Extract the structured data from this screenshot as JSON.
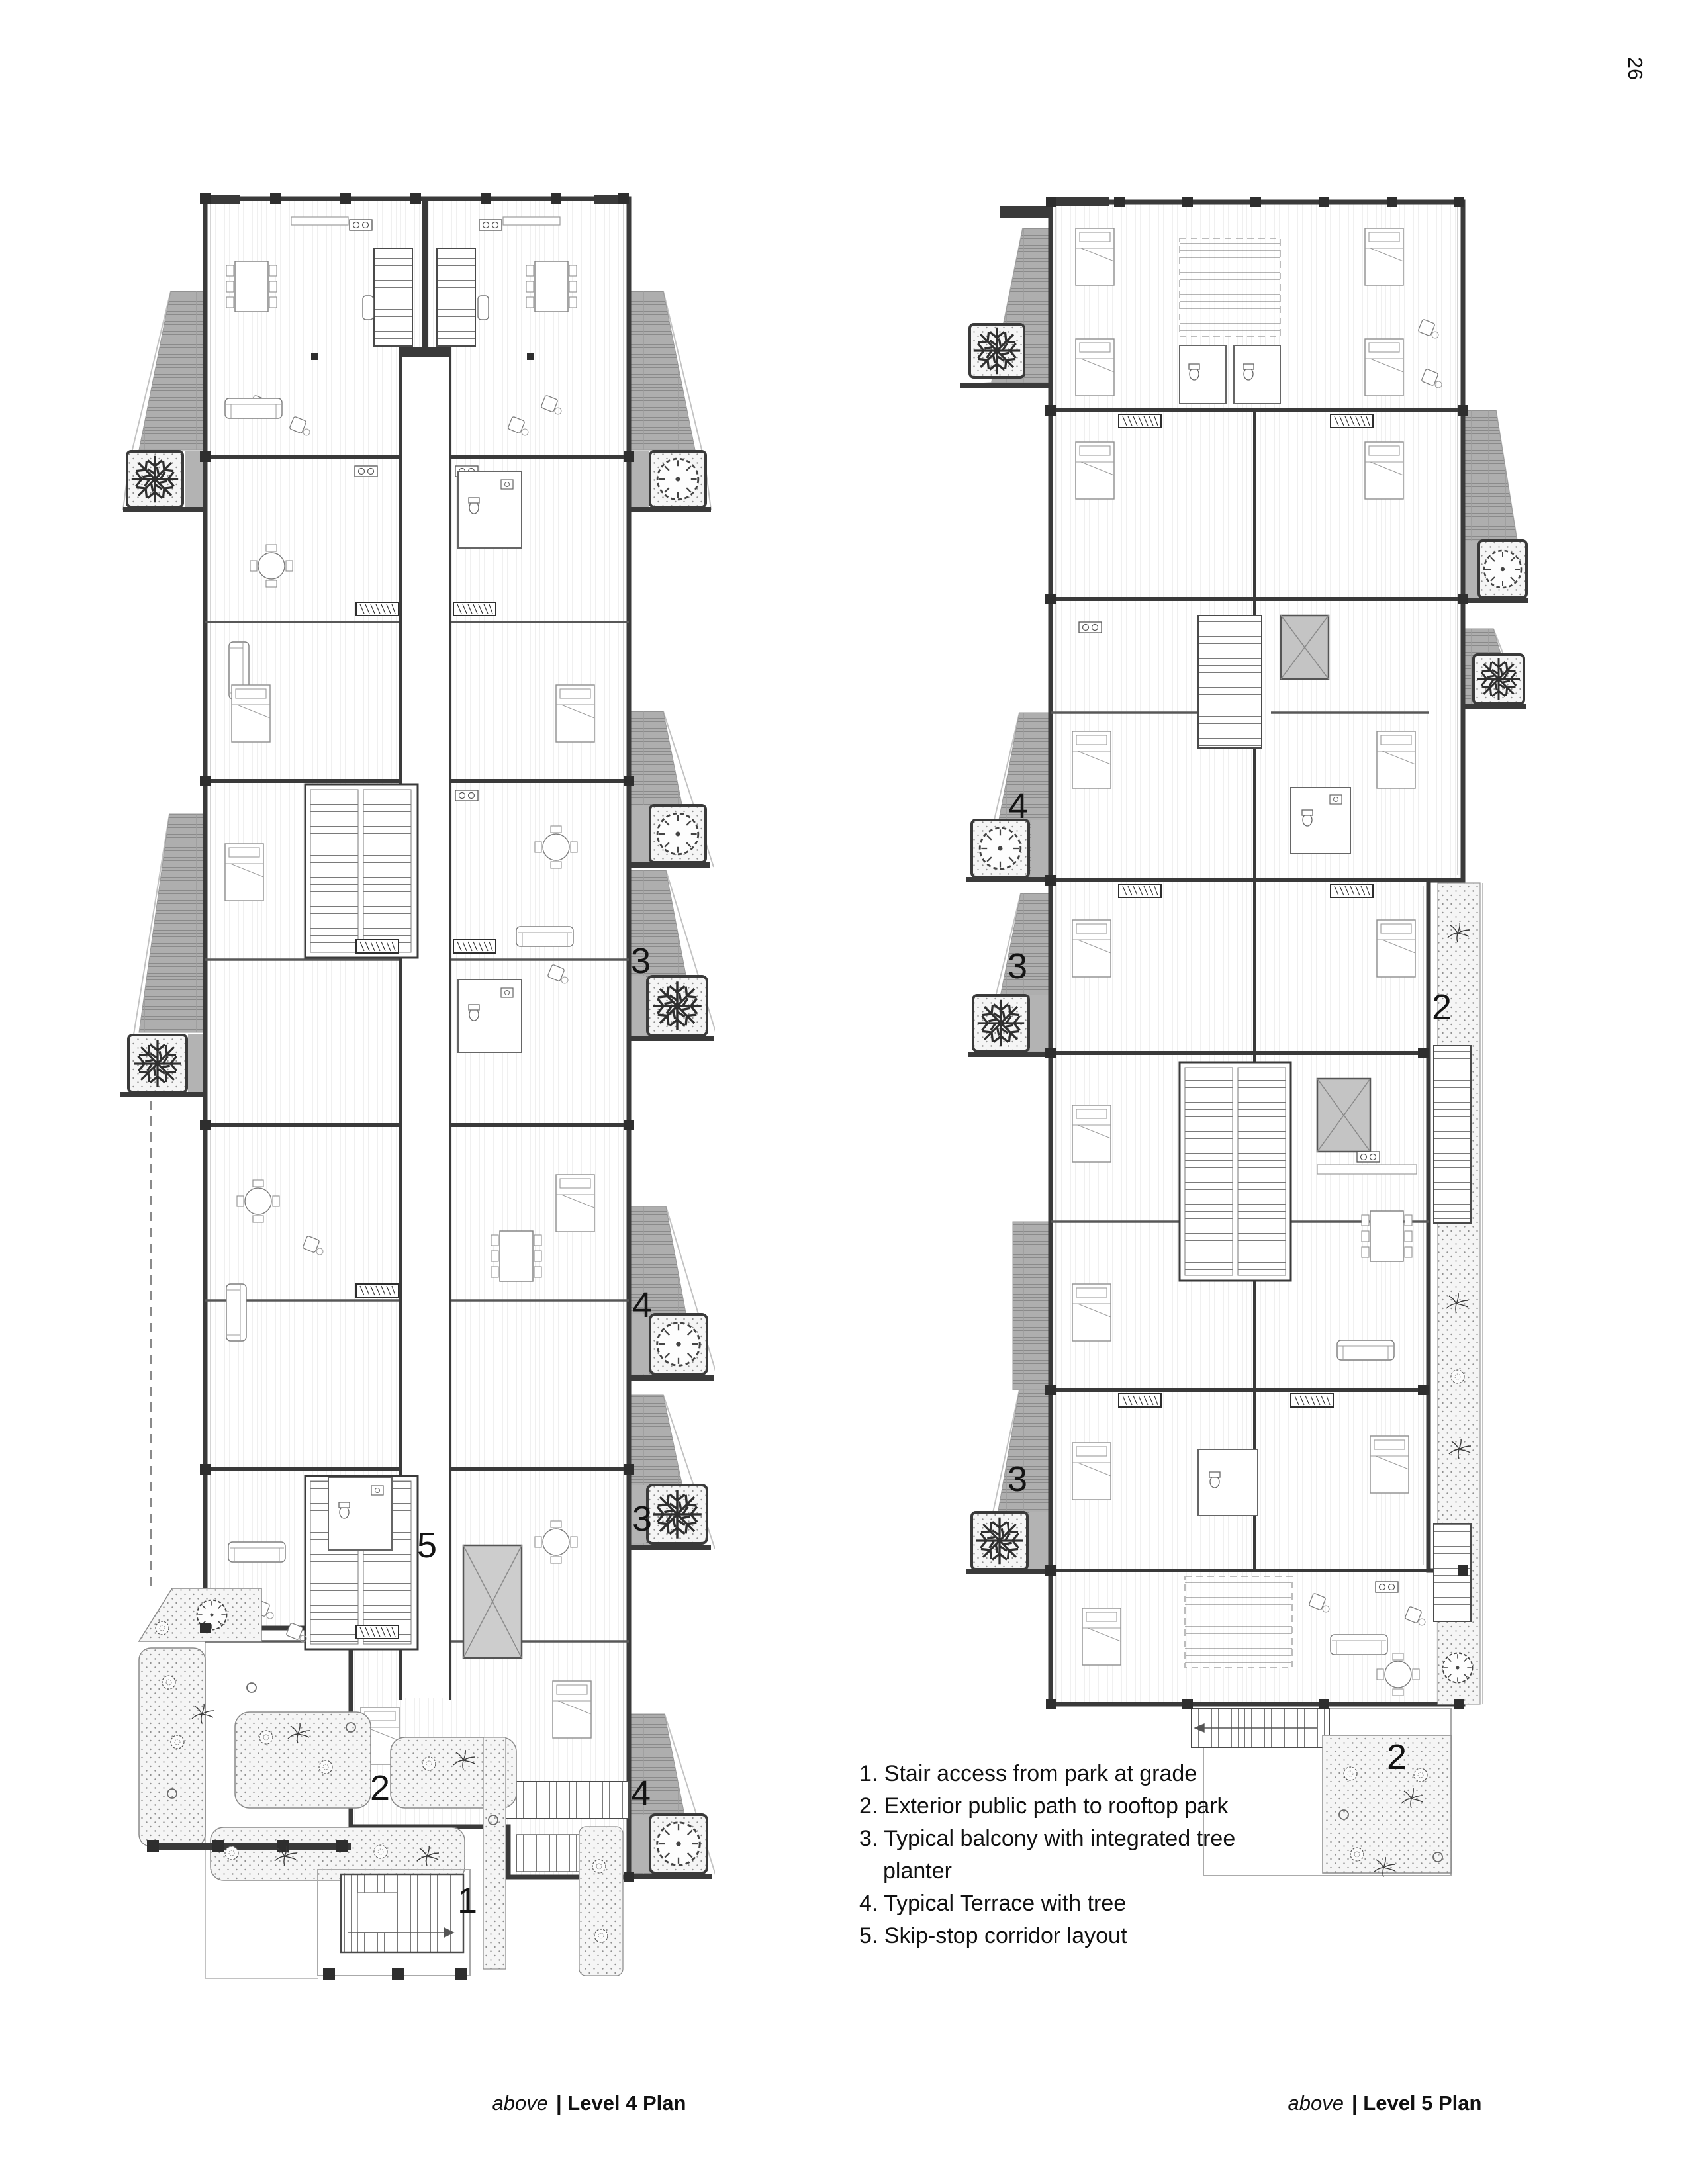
{
  "page_number": "26",
  "legend": {
    "lines": [
      "1. Stair access from park at grade",
      "2. Exterior public path to rooftop park",
      "3. Typical balcony with integrated tree",
      "planter",
      "4. Typical Terrace with tree",
      "5. Skip-stop corridor layout"
    ]
  },
  "captions": {
    "left_italic": "above",
    "left_rest": "| Level 4 Plan",
    "right_italic": "above",
    "right_rest": "| Level 5 Plan"
  },
  "plans": {
    "left": {
      "annotations": [
        {
          "label": "3"
        },
        {
          "label": "4"
        },
        {
          "label": "3"
        },
        {
          "label": "4"
        },
        {
          "label": "5"
        },
        {
          "label": "2"
        },
        {
          "label": "1"
        }
      ]
    },
    "right": {
      "annotations": [
        {
          "label": "4"
        },
        {
          "label": "3"
        },
        {
          "label": "2"
        },
        {
          "label": "3"
        },
        {
          "label": "2"
        }
      ]
    }
  },
  "colors": {
    "wall": "#3a3a3a",
    "balcony_fill": "#aeaeae",
    "planter_fill": "#f5f5f5",
    "ink": "#111111"
  }
}
